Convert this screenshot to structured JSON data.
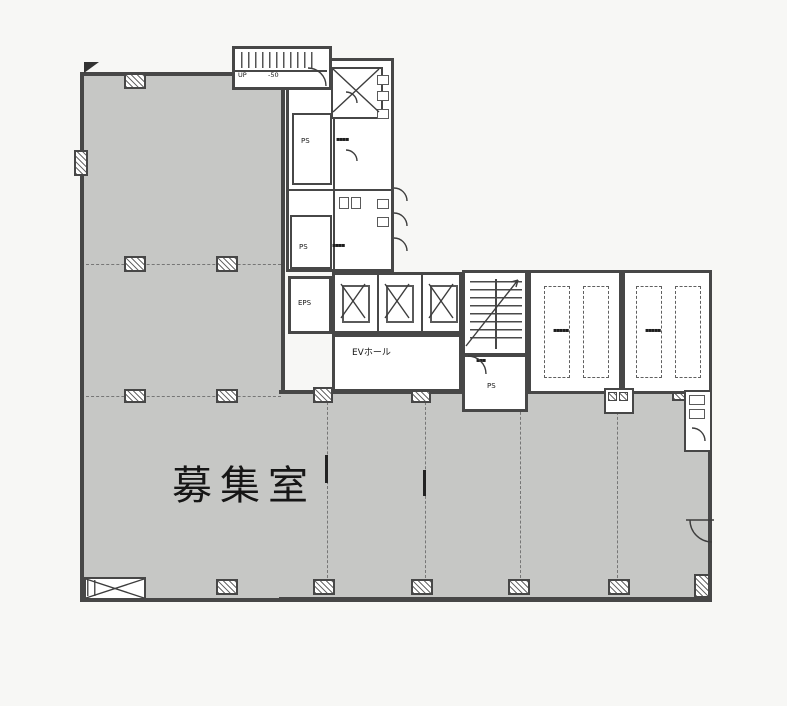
{
  "plan": {
    "vacant_room_label": "募集室",
    "ev_hall_label": "EVホール",
    "eps_label": "EPS",
    "ps_upper_label": "PS",
    "ps_mid_label": "PS",
    "ps_under_stair_label": "PS",
    "exterior_stair_up_label": "UP",
    "exterior_stair_level_label": "-50"
  },
  "illegible_labels": {
    "wc_upper": "▪▪▪▪",
    "wc_lower": "▪▪▪▪",
    "stair_side": "▪▪▪",
    "machine_room_left": "▪▪▪▪▪",
    "machine_room_right": "▪▪▪▪▪"
  },
  "colors": {
    "room_fill": "#c6c7c5",
    "wall": "#474747",
    "background": "#f7f7f5",
    "text": "#161616"
  }
}
